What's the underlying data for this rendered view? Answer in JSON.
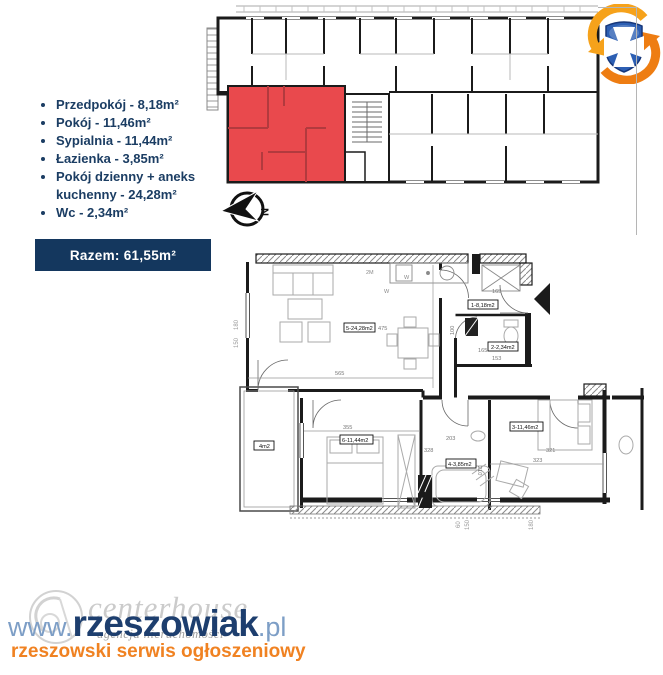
{
  "header": {
    "rooms": [
      {
        "label": "Przedpokój - 8,18m²"
      },
      {
        "label": "Pokój - 11,46m²"
      },
      {
        "label": "Sypialnia - 11,44m²"
      },
      {
        "label": "Łazienka - 3,85m²"
      },
      {
        "label": "Pokój dzienny + aneks kuchenny - 24,28m²"
      },
      {
        "label": "Wc - 2,34m²"
      }
    ],
    "total": "Razem: 61,55m²"
  },
  "colors": {
    "navy": "#14375e",
    "highlight_red": "#e9494d",
    "orange": "#f08222",
    "steel_blue": "#7d9ec6"
  },
  "compass": {
    "letter": "N"
  },
  "floor_plan": {
    "labels": {
      "living": "5-24,28m2",
      "hall": "1-8,18m2",
      "wc": "2-2,34m2",
      "bedroom": "6-11,44m2",
      "room": "3-11,46m2",
      "bath": "4-3,85m2",
      "balcony": "4m2"
    },
    "dims": {
      "living_w": "565",
      "living_h": "475",
      "bedroom_w": "355",
      "bedroom_h": "328",
      "room_h": "321",
      "room_w": "323",
      "bath_h": "210",
      "bath_w": "203",
      "hall": "165",
      "wc_h": "100",
      "wc_side": "165",
      "wc_w": "153",
      "left_top": "180",
      "left_bot": "150",
      "bot_a": "60",
      "bot_b": "150",
      "bot_c": "180"
    },
    "marks": {
      "k1": "2M",
      "k2": "W",
      "k3": "W"
    }
  },
  "watermark": {
    "brand": "centerhouse",
    "brand_sub": "agencja nieruchomości",
    "url_www": "www.",
    "url_name": "rzeszowiak",
    "url_tld": ".pl",
    "tagline": "rzeszowski serwis ogłoszeniowy"
  }
}
